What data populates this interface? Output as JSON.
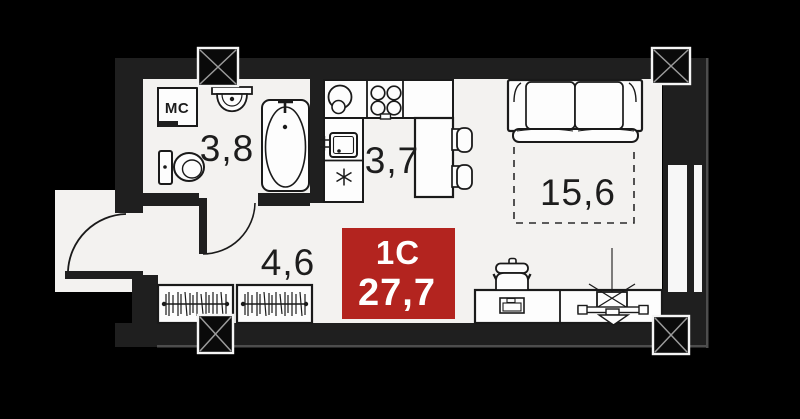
{
  "floorplan": {
    "unit": {
      "type_label": "1С",
      "total_area": "27,7"
    },
    "rooms": [
      {
        "name": "bathroom",
        "area_label": "3,8"
      },
      {
        "name": "kitchen",
        "area_label": "3,7"
      },
      {
        "name": "living-room",
        "area_label": "15,6"
      },
      {
        "name": "hallway",
        "area_label": "4,6"
      }
    ],
    "annotations": {
      "washing_machine": "МС"
    },
    "colors": {
      "background": "#000000",
      "wall": "#1f1f1f",
      "floor": "#f3f2f0",
      "fixture_line": "#1a1a1a",
      "area_badge_red": "#b3241f",
      "badge_text": "#ffffff"
    }
  }
}
